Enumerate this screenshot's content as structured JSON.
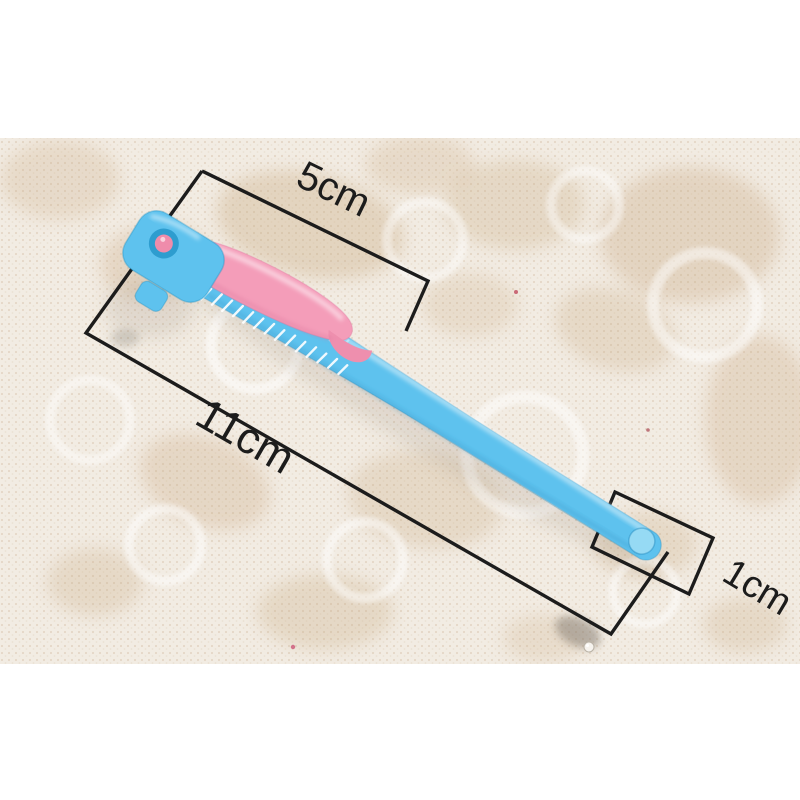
{
  "photo": {
    "subject": "Folding eyebrow razor with pink safety cover lying diagonally on white lace fabric",
    "orientation": "razor runs from upper-left head to lower-right handle tip"
  },
  "measurements": {
    "blade_length_label": "5cm",
    "overall_length_label": "11cm",
    "handle_width_label": "1cm"
  },
  "colors": {
    "margin_white": "#ffffff",
    "lace_base": "#f2ece3",
    "lace_motif": "#d3bb9c",
    "handle_blue": "#5ec2ee",
    "cover_pink": "#f49db9",
    "cover_tail_pink": "#ee8fae",
    "pivot_ring_blue": "#2e9dcf",
    "pivot_pin_pink": "#ef8cab",
    "tip_dimple_blue": "#96daf4",
    "annotation_ink": "#1c1c1c"
  }
}
